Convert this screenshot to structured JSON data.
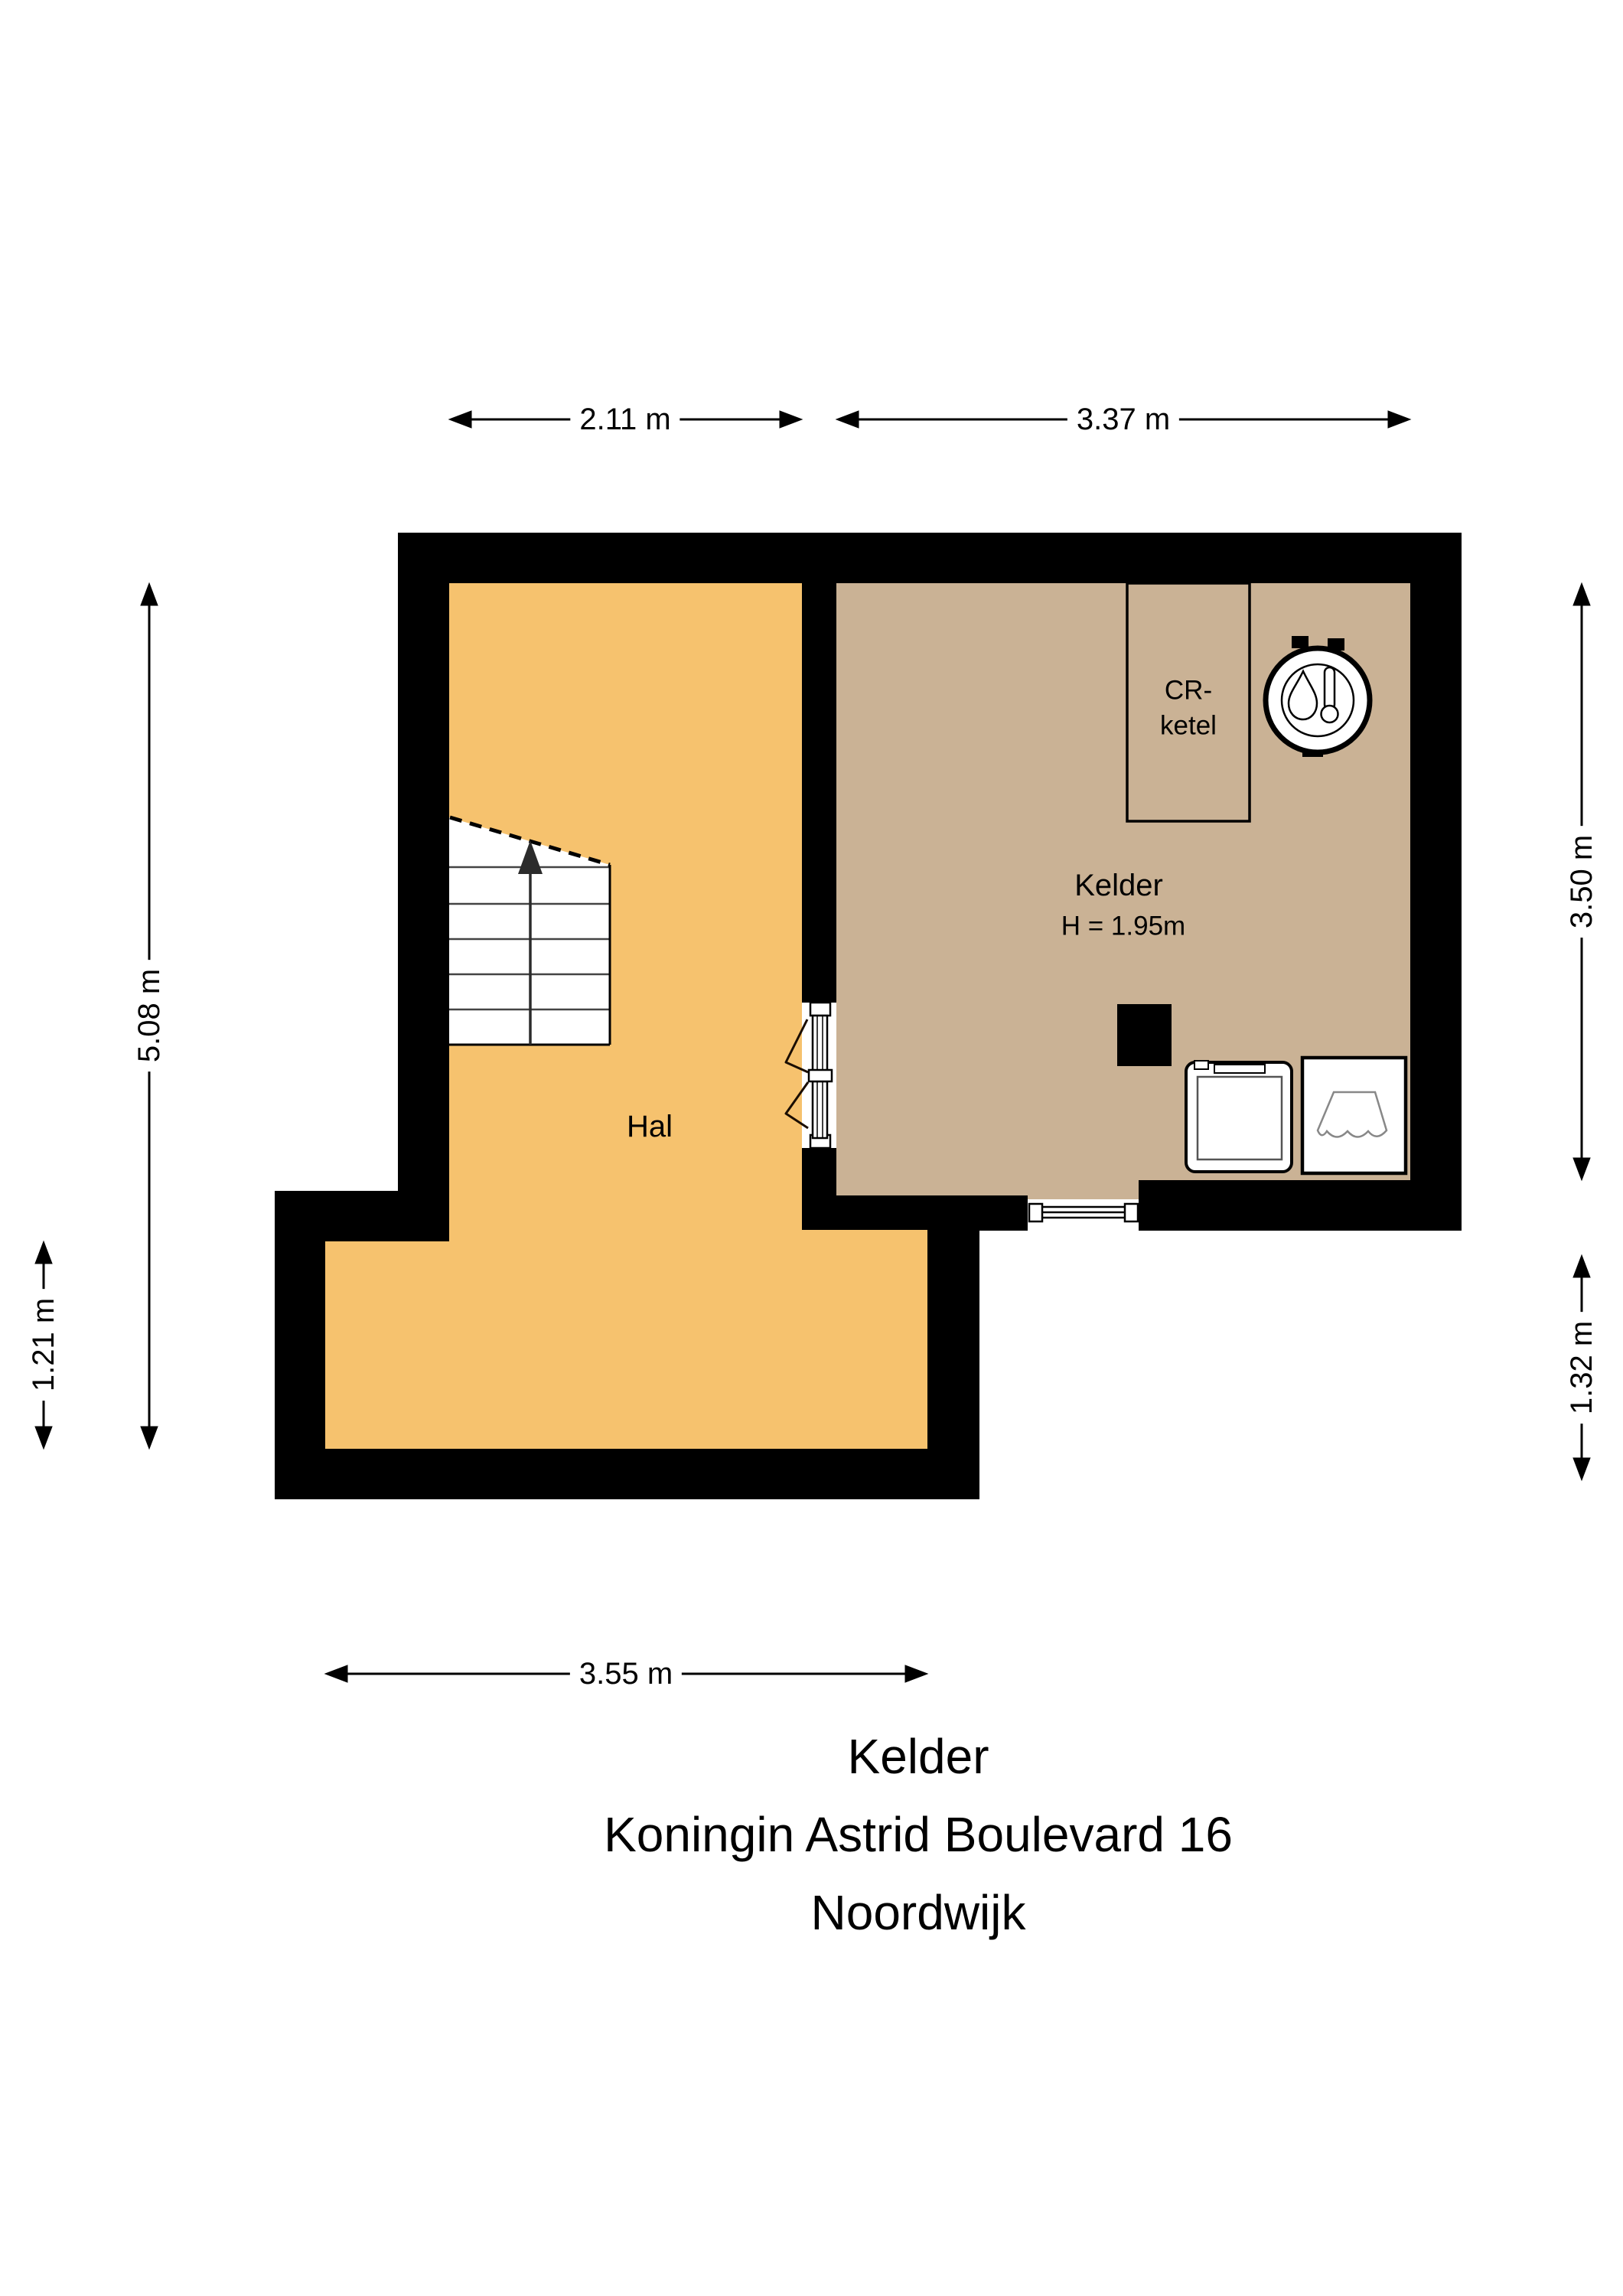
{
  "title_block": {
    "line1": "Kelder",
    "line2": "Koningin Astrid Boulevard 16",
    "line3": "Noordwijk"
  },
  "rooms": {
    "hal": {
      "label": "Hal"
    },
    "kelder": {
      "label": "Kelder",
      "ceiling_height": "H = 1.95m"
    },
    "cr_ketel_closet": {
      "label_line1": "CR-",
      "label_line2": "ketel"
    }
  },
  "dimensions": {
    "top_left_width": "2.11 m",
    "top_right_width": "3.37 m",
    "left_total_height": "5.08 m",
    "left_lower_height": "1.21 m",
    "right_upper_height": "3.50 m",
    "right_lower_height": "1.32 m",
    "bottom_width": "3.55 m"
  },
  "colors": {
    "background": "#FFFFFF",
    "wall": "#000000",
    "hal_floor": "#F6C26E",
    "kelder_floor": "#CAB295",
    "stairs_line": "#444444",
    "basket_outline": "#888888"
  },
  "icons": {
    "boiler": "boiler-icon",
    "washing_machine": "washing-machine-icon",
    "laundry_basket": "laundry-basket-icon",
    "stairs_arrow": "stairs-up-arrow-icon"
  }
}
